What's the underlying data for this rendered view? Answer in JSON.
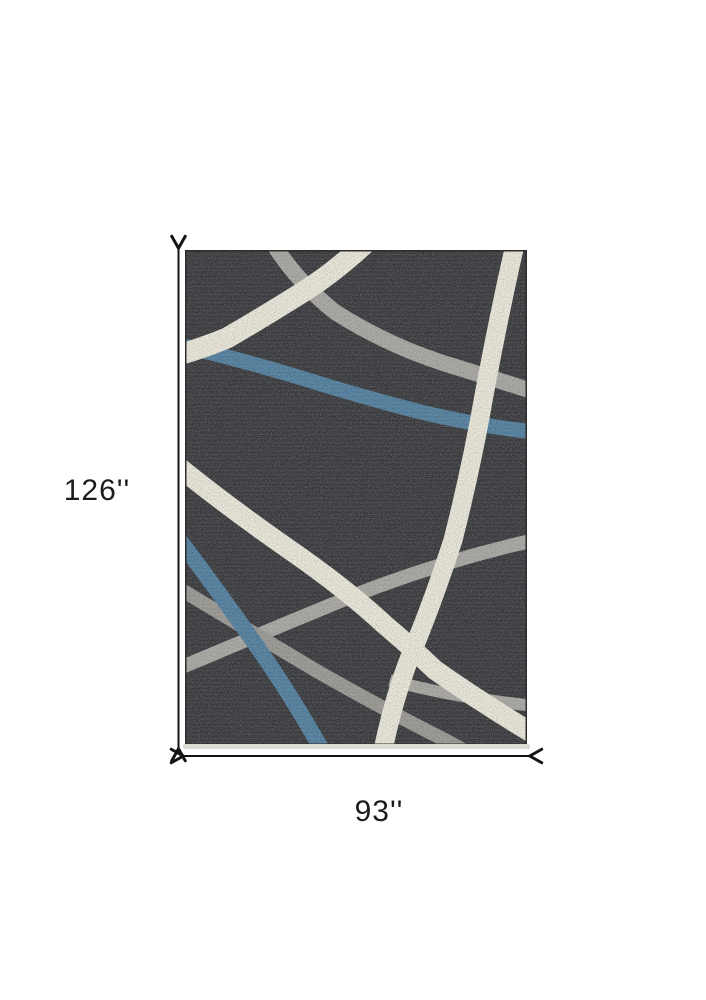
{
  "meta": {
    "view": "product-dimension-diagram",
    "subject": "abstract striped area rug"
  },
  "rug": {
    "colors": {
      "base": "#37383b",
      "ivory": "#ece9db",
      "gray_light": "#a9a7a2",
      "gray_mid": "#9a9893",
      "blue": "#4f7e9e",
      "outline": "#2d2d2d",
      "edge": "#dcdbd5"
    }
  },
  "dimensions": {
    "height_label": "126''",
    "width_label": "93''",
    "line_color": "#141414"
  }
}
